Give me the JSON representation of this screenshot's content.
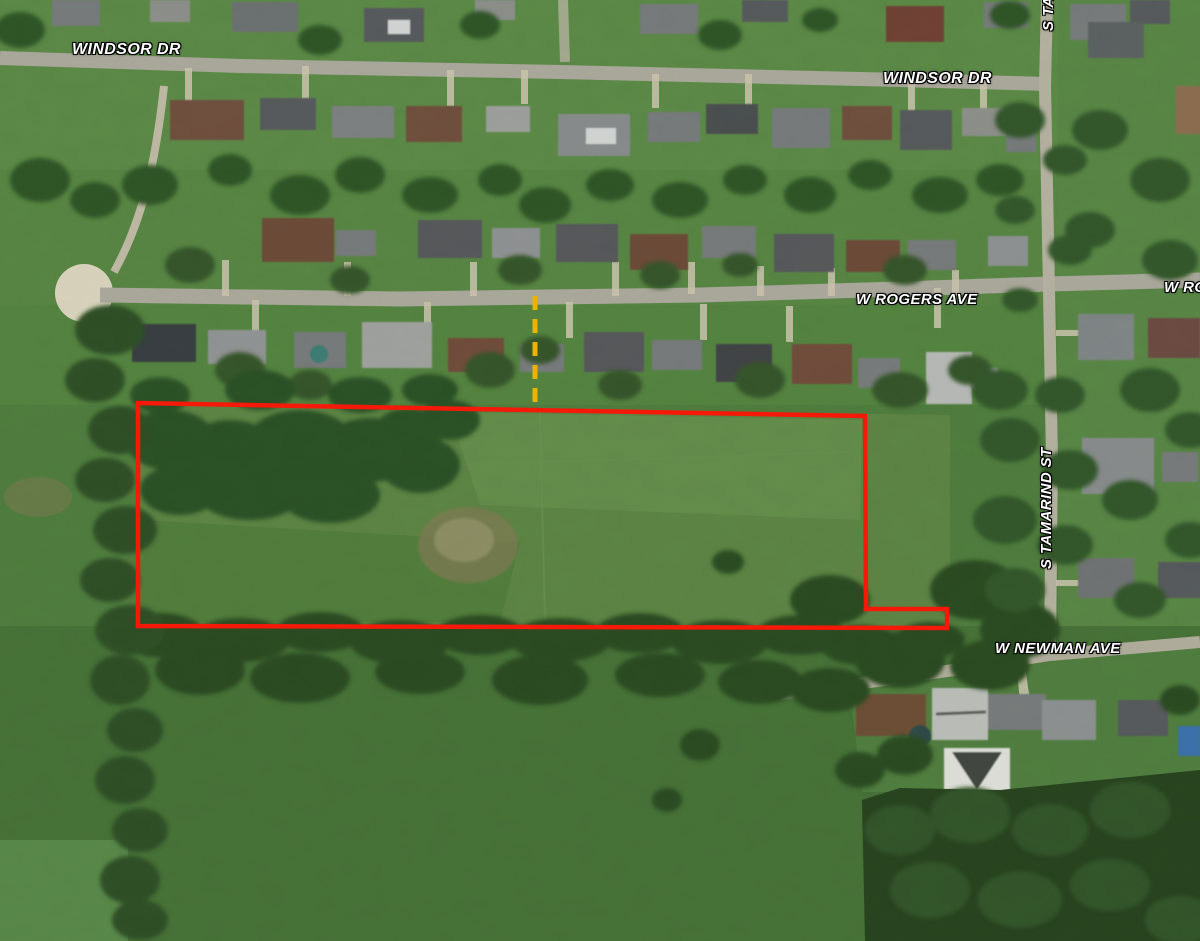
{
  "map": {
    "street_labels": [
      {
        "id": "windsor-dr-left",
        "text": "WINDSOR DR"
      },
      {
        "id": "windsor-dr-right",
        "text": "WINDSOR DR"
      },
      {
        "id": "w-rogers-ave",
        "text": "W ROGERS AVE"
      },
      {
        "id": "w-rogers-ave-right",
        "text": "W ROGERS AVE"
      },
      {
        "id": "s-tamarind-st",
        "text": "S TAMARIND ST"
      },
      {
        "id": "s-tamarind-st-top",
        "text": "S TAMARIND ST"
      },
      {
        "id": "w-newman-ave",
        "text": "W NEWMAN AVE"
      }
    ],
    "parcel": {
      "outline_color": "#f5190a",
      "split_line_color": "#e8b400"
    },
    "label_text_color": "#ffffff"
  }
}
